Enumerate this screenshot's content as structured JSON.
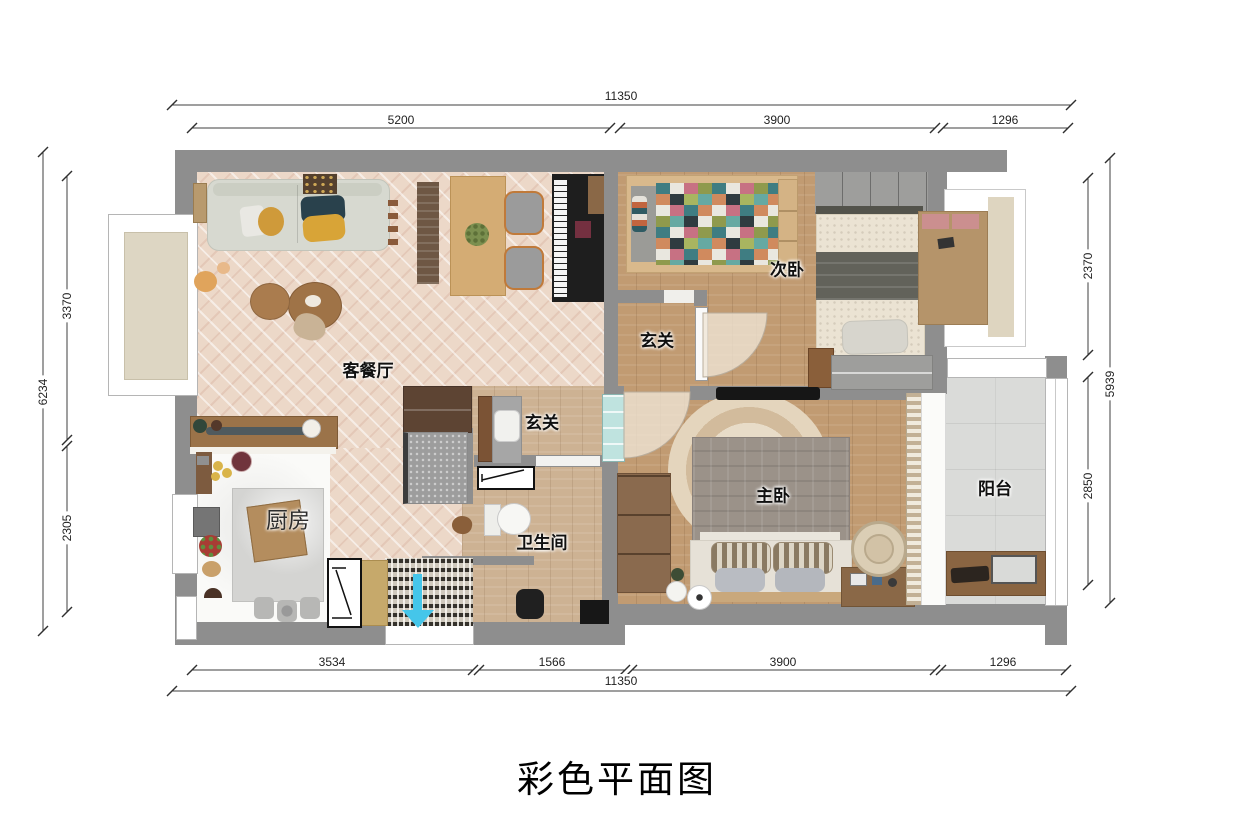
{
  "title": "彩色平面图",
  "rooms": {
    "living": "客餐厅",
    "kitchen": "厨房",
    "bathroom": "卫生间",
    "hallway_upper": "玄关",
    "hallway_lower": "玄关",
    "bedroom2": "次卧",
    "master": "主卧",
    "balcony": "阳台"
  },
  "dimensions": {
    "top": {
      "total": "11350",
      "segments": [
        "5200",
        "3900",
        "1296"
      ]
    },
    "bottom": {
      "total": "11350",
      "segments": [
        "3534",
        "1566",
        "3900",
        "1296"
      ]
    },
    "left": {
      "total": "6234",
      "segments": [
        "3370",
        "2305"
      ]
    },
    "right": {
      "total": "5939",
      "segments": [
        "2370",
        "2850"
      ]
    }
  },
  "colors": {
    "wall": "#8e8e8e",
    "living_floor": "#ecd8c8",
    "wood_floor": "#c19b72",
    "balcony_floor": "#dadbd9",
    "entrance_arrow": "#45c6ea"
  }
}
